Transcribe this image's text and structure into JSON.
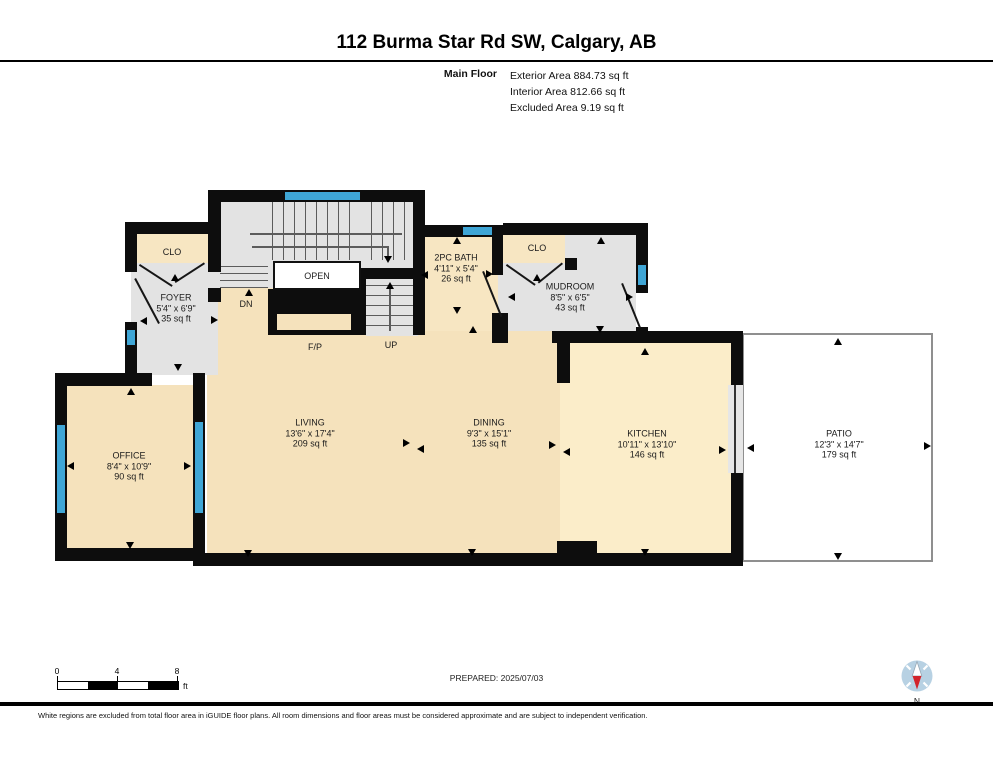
{
  "header": {
    "title": "112 Burma Star Rd SW, Calgary, AB",
    "floor_label": "Main Floor",
    "exterior_area": "Exterior Area 884.73 sq ft",
    "interior_area": "Interior Area 812.66 sq ft",
    "excluded_area": "Excluded Area 9.19 sq ft"
  },
  "rooms": [
    {
      "name": "FOYER",
      "dims": "5'4\" x 6'9\"",
      "area": "35 sq ft"
    },
    {
      "name": "OFFICE",
      "dims": "8'4\" x 10'9\"",
      "area": "90 sq ft"
    },
    {
      "name": "LIVING",
      "dims": "13'6\" x 17'4\"",
      "area": "209 sq ft"
    },
    {
      "name": "DINING",
      "dims": "9'3\" x 15'1\"",
      "area": "135 sq ft"
    },
    {
      "name": "KITCHEN",
      "dims": "10'11\" x 13'10\"",
      "area": "146 sq ft"
    },
    {
      "name": "PATIO",
      "dims": "12'3\" x 14'7\"",
      "area": "179 sq ft"
    },
    {
      "name": "2PC BATH",
      "dims": "4'11\" x 5'4\"",
      "area": "26 sq ft"
    },
    {
      "name": "MUDROOM",
      "dims": "8'5\" x 6'5\"",
      "area": "43 sq ft"
    }
  ],
  "plan_labels": {
    "closet1": "CLO",
    "closet2": "CLO",
    "open": "OPEN",
    "down": "DN",
    "up": "UP",
    "fireplace": "F/P"
  },
  "scale_bar": {
    "tick0": "0",
    "tick4": "4",
    "tick8": "8",
    "unit": "ft"
  },
  "compass": {
    "north_label": "N"
  },
  "footer": {
    "prepared": "PREPARED: 2025/07/03",
    "disclaimer": "White regions are excluded from total floor area in iGUIDE floor plans. All room dimensions and floor areas must be considered approximate and are subject to independent verification."
  },
  "colors": {
    "window_blue": "#3fa6d6",
    "floor_beige": "#f5e2bc",
    "floor_kitchen": "#fbedc9",
    "floor_grey": "#e3e3e3",
    "wall_black": "#0d0d0d",
    "compass_red": "#d2232a"
  }
}
